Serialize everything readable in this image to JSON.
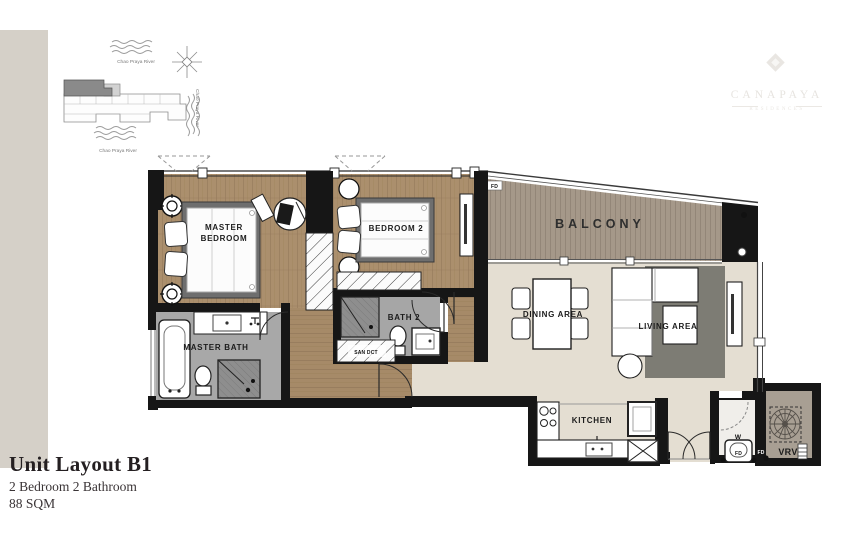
{
  "title_block": {
    "title": "Unit Layout B1",
    "subtitle": "2 Bedroom 2 Bathroom",
    "area": "88 SQM"
  },
  "logo": {
    "brand": "CANAPAYA",
    "brand_sub": "RESIDENCES"
  },
  "site_map": {
    "river_top": "Chao Praya River",
    "river_right": "Chao Praya River",
    "river_bottom": "Chao Praya River"
  },
  "plan": {
    "labels": {
      "master_bedroom_line1": "MASTER",
      "master_bedroom_line2": "BEDROOM",
      "bedroom2": "BEDROOM 2",
      "balcony": "BALCONY",
      "dining": "DINING AREA",
      "living": "LIVING AREA",
      "kitchen": "KITCHEN",
      "master_bath": "MASTER BATH",
      "bath2": "BATH 2",
      "san_duct": "SAN DCT",
      "vrv": "VRV",
      "washer_w": "W",
      "washer_fd": "FD",
      "vrv_fd": "FD",
      "balcony_fd": "FD"
    }
  },
  "colors": {
    "page_strip": "#d5d0c8",
    "wall": "#161616",
    "wood_floor": "#ab8f6d",
    "living_floor": "#e4ded2",
    "balcony_deck": "#a59889",
    "bath_floor": "#a6a6a6",
    "rug": "#7d7c74",
    "logo_watermark": "#e8e5e1"
  }
}
